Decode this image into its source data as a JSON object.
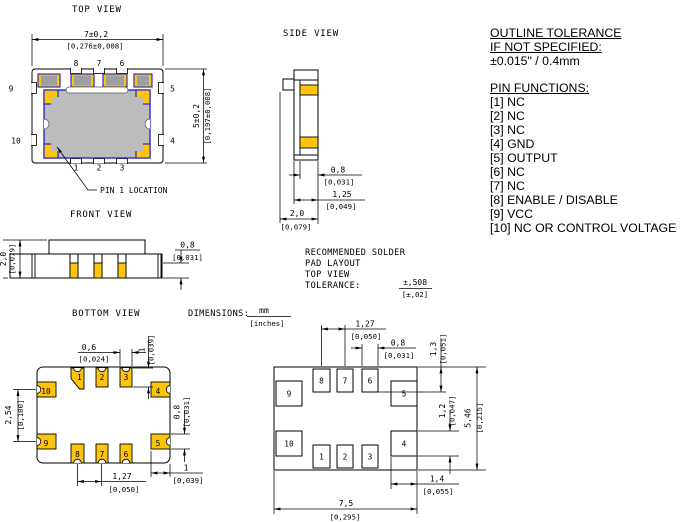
{
  "pin_labels": [
    "1",
    "2",
    "3",
    "4",
    "5",
    "6",
    "7",
    "8",
    "9",
    "10"
  ],
  "colors": {
    "pad_yellow": "#FDC40D",
    "body_gray": "#BCBCBC",
    "outline_blue": "#1D1DC9",
    "line": "#000000"
  },
  "top_view": {
    "title": "TOP VIEW",
    "dim_width": {
      "mm": "7±0,2",
      "in": "[0,276±0,008]"
    },
    "dim_height": {
      "mm": "5±0,2",
      "in": "[0,197±0,008]"
    },
    "pin1_label": "PIN 1 LOCATION"
  },
  "side_view": {
    "title": "SIDE VIEW",
    "dim_pad_height": {
      "mm": "0,8",
      "in": "[0,031]"
    },
    "dim_lid": {
      "mm": "1,25",
      "in": "[0,049]"
    },
    "dim_depth": {
      "mm": "2,0",
      "in": "[0,079]"
    }
  },
  "front_view": {
    "title": "FRONT VIEW",
    "dim_height": {
      "mm": "2,0",
      "in": "[0,079]"
    },
    "dim_pad_height": {
      "mm": "0,8",
      "in": "[0,031]"
    }
  },
  "bottom_view": {
    "title": "BOTTOM VIEW",
    "dim_pad_width": {
      "mm": "0,6",
      "in": "[0,024]"
    },
    "dim_pad_length": {
      "mm": "1",
      "in": "[0,039]"
    },
    "dim_side_pitch": {
      "mm": "2,54",
      "in": "[0,100]"
    },
    "dim_side_pad_height": {
      "mm": "0,8",
      "in": "[0,031]"
    },
    "dim_pitch": {
      "mm": "1,27",
      "in": "[0,050]"
    },
    "dim_side_pad_width": {
      "mm": "1",
      "in": "[0,039]"
    }
  },
  "solder_layout": {
    "title_line1": "RECOMMENDED SOLDER",
    "title_line2": "PAD LAYOUT",
    "title_line3": "TOP VIEW",
    "tolerance_label": "TOLERANCE:",
    "tolerance": {
      "mm": "±,508",
      "in": "[±,02]"
    },
    "dim_pitch": {
      "mm": "1,27",
      "in": "[0,050]"
    },
    "dim_pad_width": {
      "mm": "0,8",
      "in": "[0,031]"
    },
    "dim_top_row": {
      "mm": "1,3",
      "in": "[0,051]"
    },
    "dim_side_pad": {
      "mm": "1,2",
      "in": "[0,047]"
    },
    "dim_height": {
      "mm": "5,46",
      "in": "[0,215]"
    },
    "dim_corner_pad": {
      "mm": "1,4",
      "in": "[0,055]"
    },
    "dim_width": {
      "mm": "7,5",
      "in": "[0,295]"
    }
  },
  "dimensions_note": {
    "label": "DIMENSIONS:",
    "mm": "mm",
    "in": "[inches]"
  },
  "notes": {
    "outline_tolerance_line1": "OUTLINE TOLERANCE",
    "outline_tolerance_line2": "IF NOT SPECIFIED:",
    "outline_tolerance_value": "±0.015\" / 0.4mm",
    "pin_functions_title": "PIN FUNCTIONS:",
    "pin_functions": [
      "[1] NC",
      "[2] NC",
      "[3] NC",
      "[4] GND",
      "[5] OUTPUT",
      "[6] NC",
      "[7] NC",
      "[8] ENABLE / DISABLE",
      "[9] VCC",
      "[10] NC OR CONTROL VOLTAGE"
    ]
  }
}
